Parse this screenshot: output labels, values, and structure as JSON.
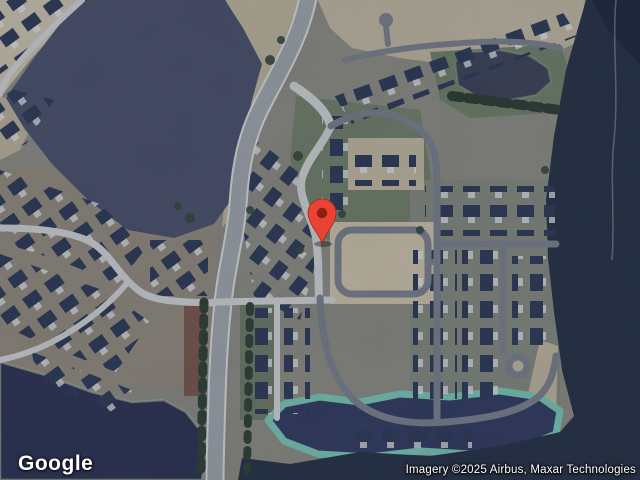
{
  "map": {
    "logo": "Google",
    "attribution": "Imagery ©2025 Airbus, Maxar Technologies",
    "marker": {
      "label": "selected-location-pin",
      "color": "#EA4335",
      "dot_color": "#8E1D12"
    },
    "imagery": {
      "view_type": "satellite",
      "scene": "suburban residential subdivision with forest and ponds"
    },
    "colors": {
      "water_dark": "#333B5E",
      "water_pond": "#2D3452",
      "forest_northwest": "#4A4F68",
      "forest_east": "#273246",
      "pond_fringe": "#74BCA9",
      "road_concrete": "#C6C8C6",
      "road_asphalt": "#747A83",
      "house_roof": "#2E3A55",
      "sand": "#BFB59E"
    }
  }
}
